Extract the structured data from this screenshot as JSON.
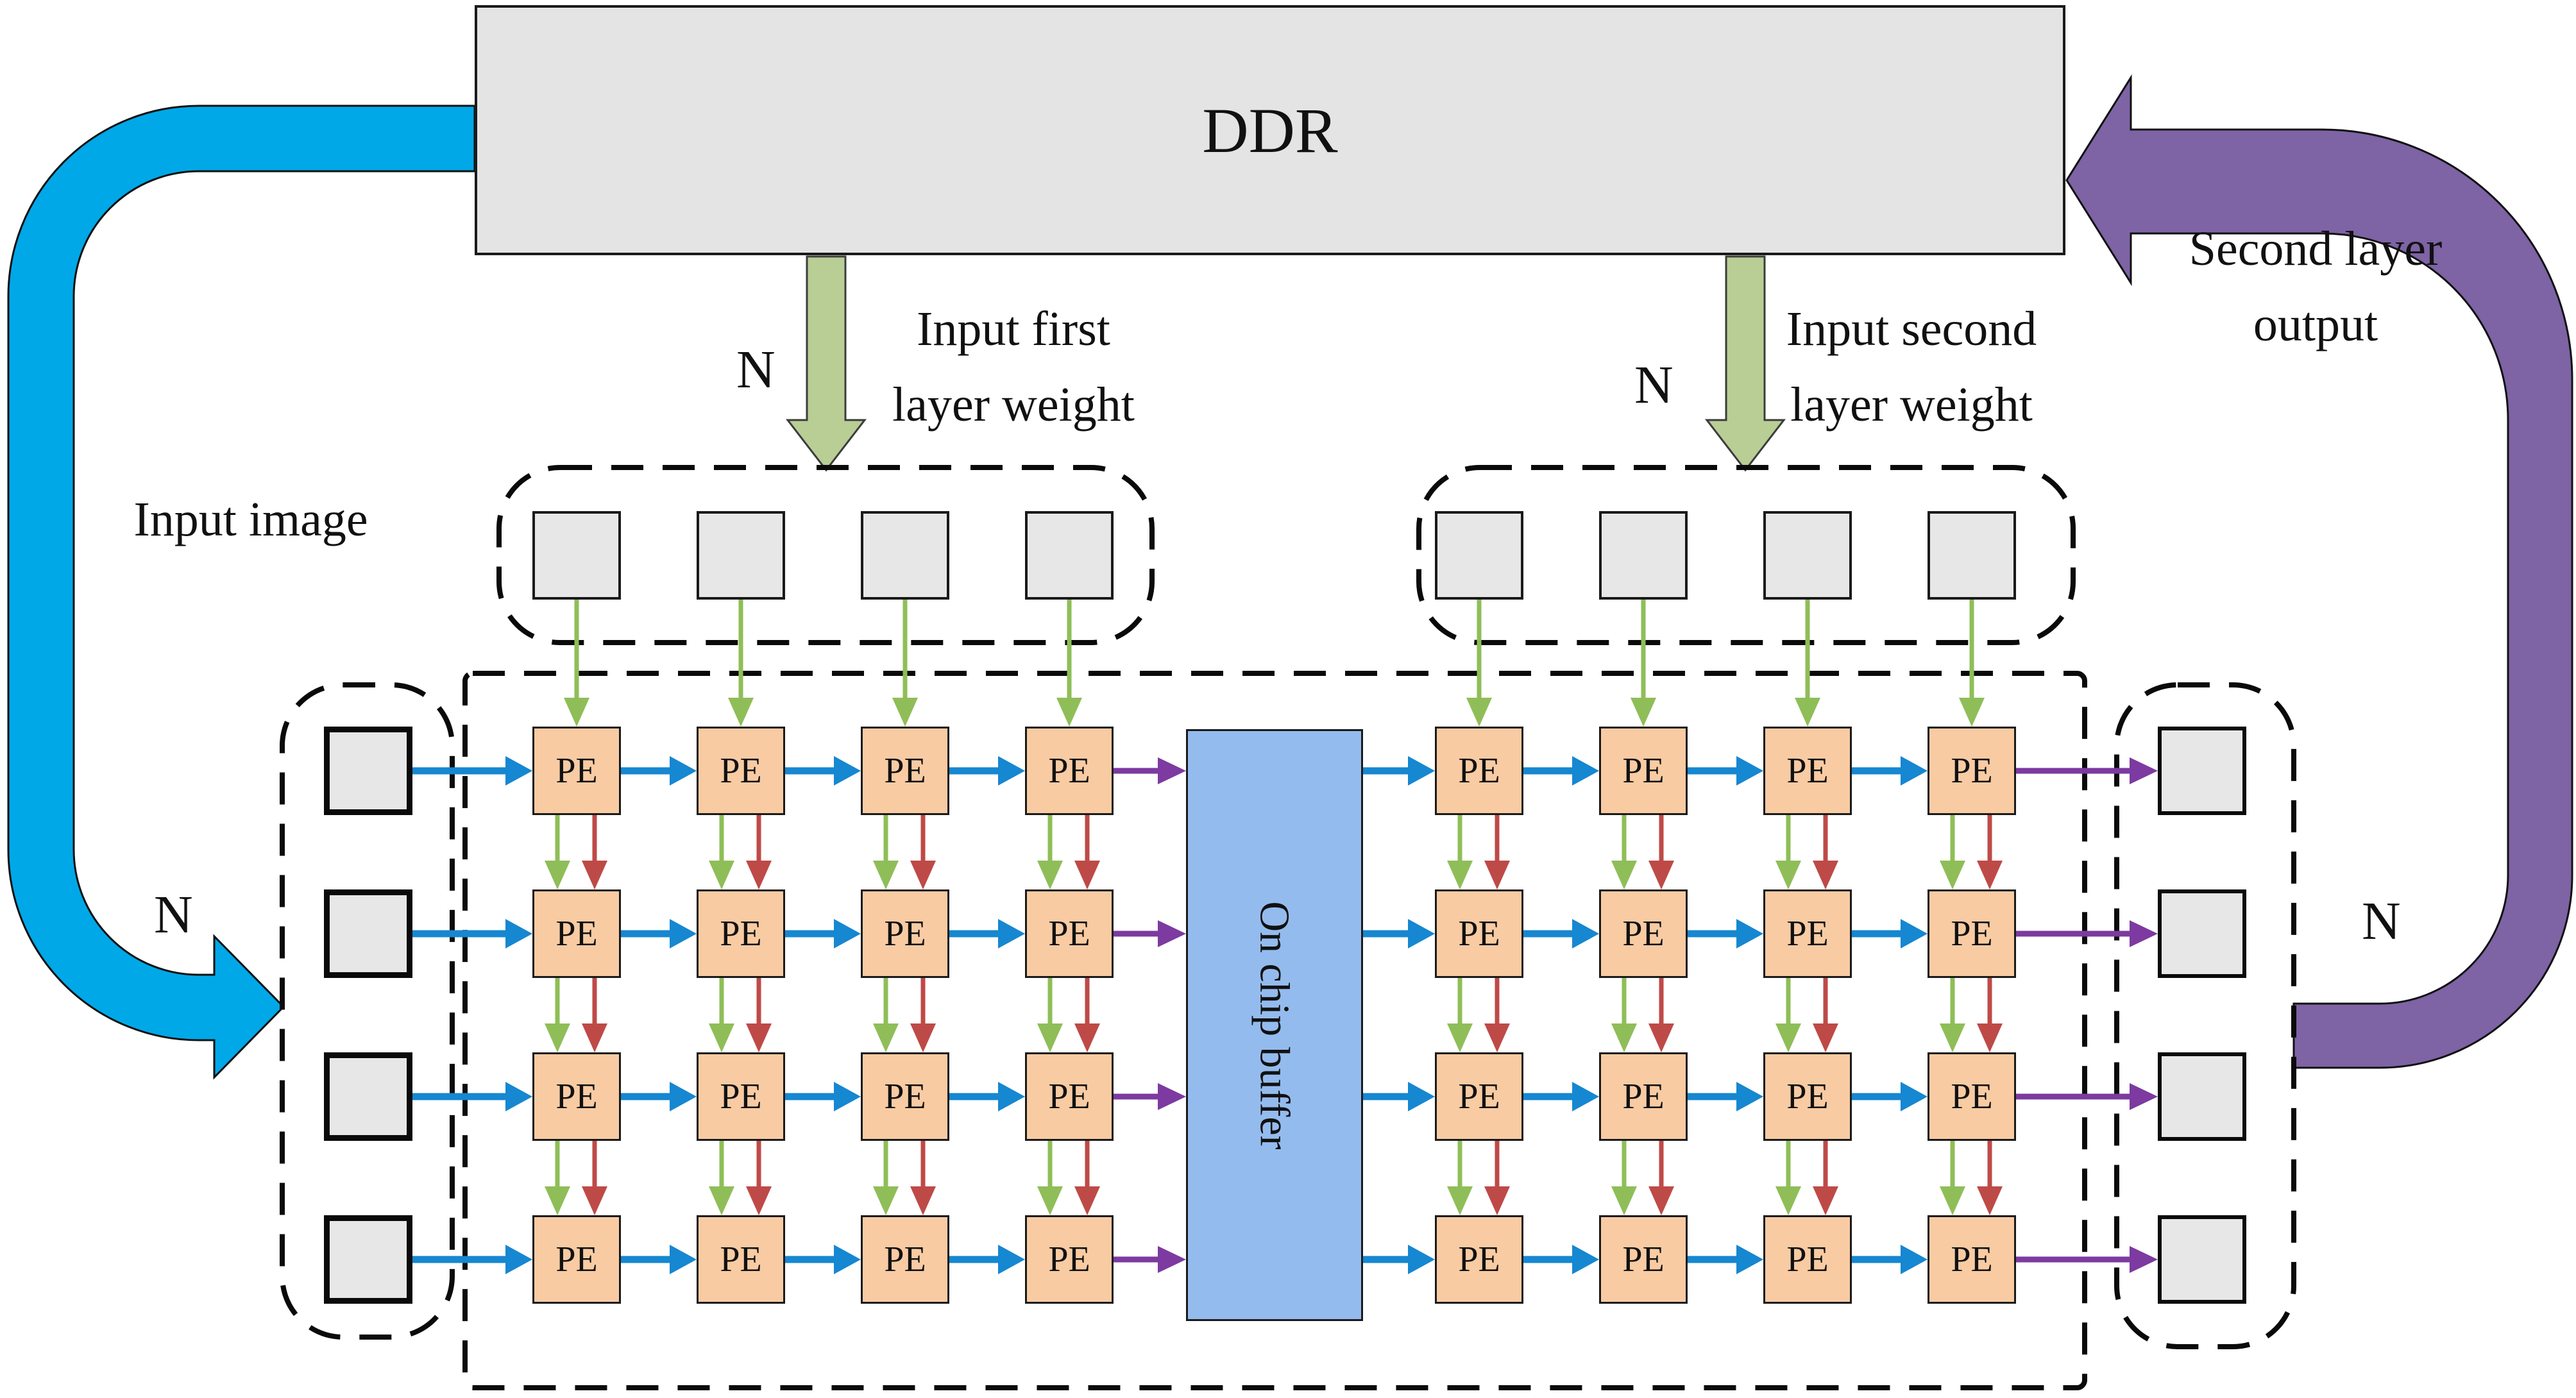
{
  "ddr": {
    "label": "DDR"
  },
  "on_chip_buffer": {
    "label": "On chip buffer"
  },
  "pe_array": {
    "label": "PE",
    "rows": 4,
    "cols_per_group": 4,
    "groups": 2
  },
  "annotations": {
    "input_image": "Input image",
    "input_first_layer_weight": [
      "Input first",
      "layer weight"
    ],
    "input_second_layer_weight": [
      "Input second",
      "layer weight"
    ],
    "second_layer_output": [
      "Second layer",
      "output"
    ],
    "n_weight_left": "N",
    "n_weight_right": "N",
    "n_input": "N",
    "n_output": "N"
  },
  "colors": {
    "arrow_blue": "#1687D1",
    "arrow_green": "#8FBE58",
    "arrow_red": "#BE4A47",
    "arrow_purple": "#7D3AA0",
    "flow_cyan": "#00A8E8",
    "flow_purple": "#7E63A5",
    "weight_arrow_green": "#B9CE95",
    "pe_fill": "#F8CBA3",
    "buffer_fill": "#94BBEE",
    "box_gray": "#E7E7E7",
    "ddr_fill": "#E4E4E4"
  }
}
